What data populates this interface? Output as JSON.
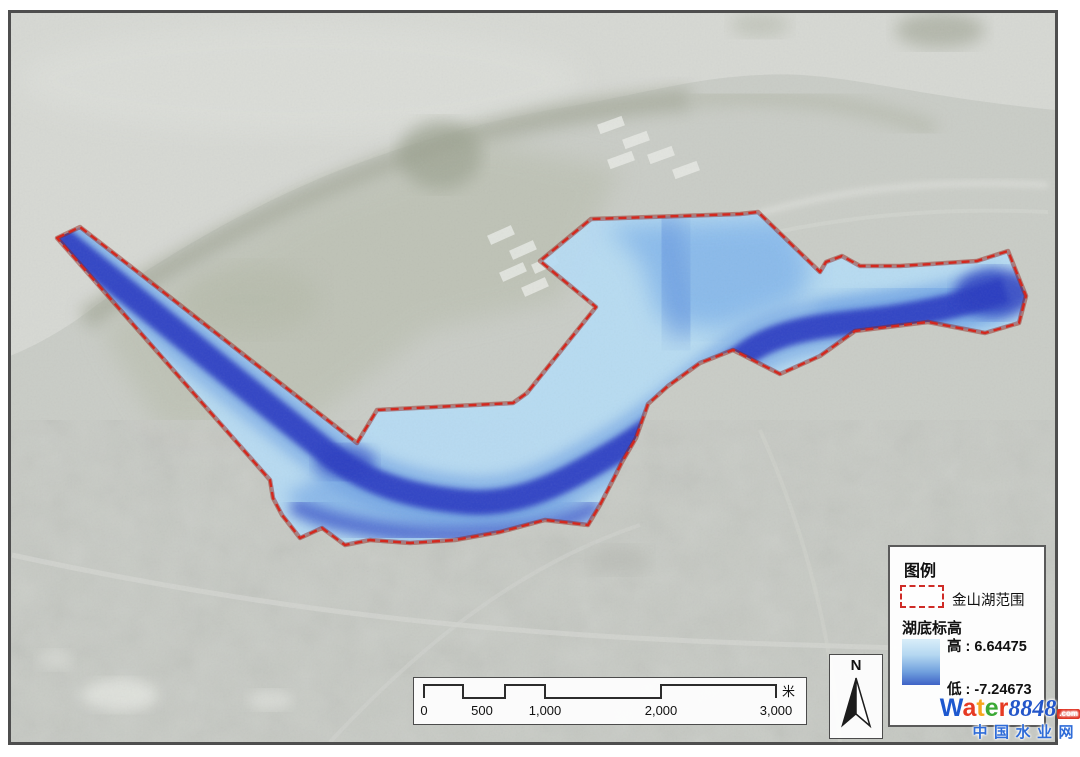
{
  "legend": {
    "title": "图例",
    "items": [
      {
        "label": "金山湖范围",
        "symbol": "red-dashed-rectangle",
        "symbol_color": "#cf2b26"
      }
    ],
    "elevation": {
      "title": "湖底标高",
      "high_prefix": "高 :",
      "high_value": "6.64475",
      "low_prefix": "低 :",
      "low_value": "-7.24673",
      "gradient_top_color": "#d9eef9",
      "gradient_bottom_color": "#3f63c6"
    }
  },
  "scale_bar": {
    "tick_labels": [
      "0",
      "500",
      "1,000",
      "2,000",
      "3,000"
    ],
    "unit_label": "米"
  },
  "north_arrow": {
    "label": "N"
  },
  "watermark": {
    "brand": [
      {
        "ch": "W",
        "style": "color:#1d58cf"
      },
      {
        "ch": "a",
        "style": "color:#e63a23"
      },
      {
        "ch": "t",
        "style": "color:#f6a51e"
      },
      {
        "ch": "e",
        "style": "color:#3aa935"
      },
      {
        "ch": "r",
        "style": "color:#e63a23"
      }
    ],
    "brand_number": "8848",
    "brand_domain": ".com",
    "subtitle": "中国水业网"
  },
  "map": {
    "boundary_name": "金山湖范围",
    "boundary_color": "#d3281e",
    "lake_shallow_color": "#b6dbf4",
    "lake_deep_color": "#2c3ec0",
    "basemap": "grayscale-aerial-imagery"
  }
}
